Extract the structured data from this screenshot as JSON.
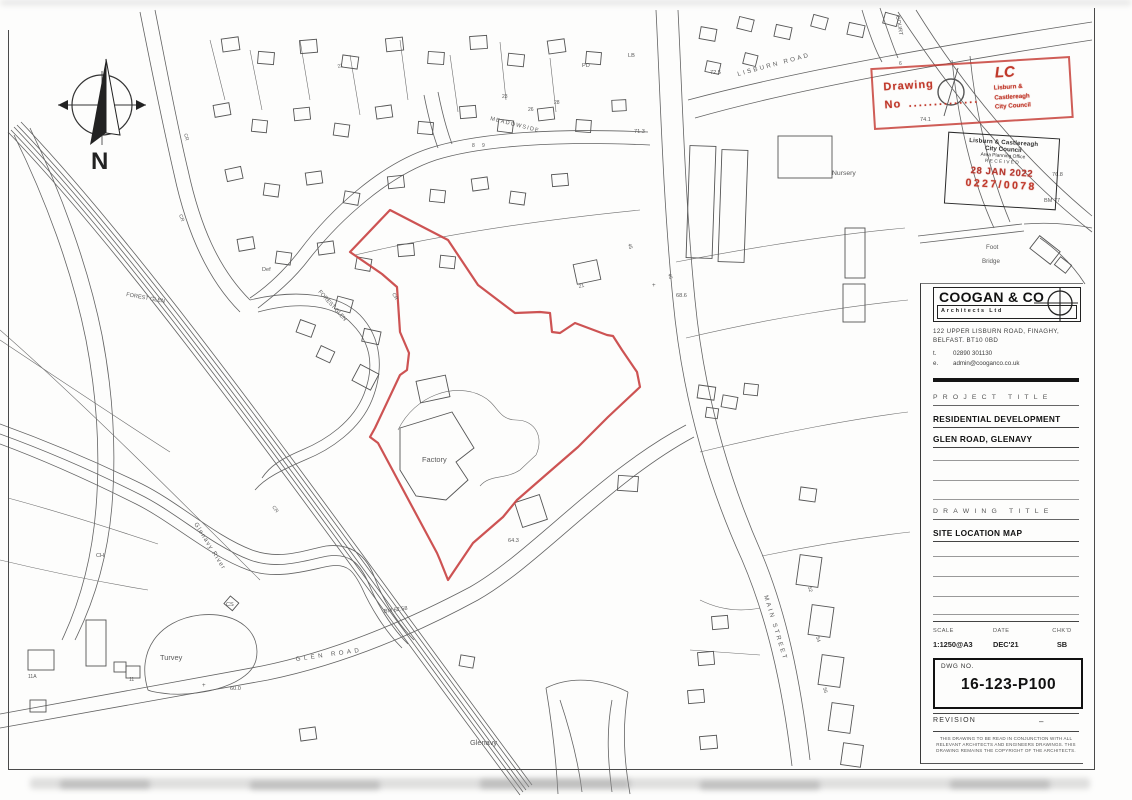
{
  "colors": {
    "boundary": "#c84040",
    "stamp_red": "#c0392b",
    "ink": "#5a5a5a"
  },
  "compass": {
    "north": "N"
  },
  "labels": {
    "meadowside": "MEADOWSIDE",
    "lisburn_road": "LISBURN ROAD",
    "court": "COURT",
    "main_street": "MAIN STREET",
    "glen_road": "GLEN ROAD",
    "forest_glen": "FOREST GLEN",
    "glenavy_river": "Glenavy River",
    "glenavy_village": "Glenavy",
    "turvey": "Turvey",
    "factory": "Factory",
    "nursery": "Nursery",
    "foot": "Foot",
    "bridge": "Bridge",
    "pd": "PD",
    "lb": "LB",
    "def": "Def",
    "cr": "CR",
    "ch": "CH",
    "cs": "CS",
    "bm77": "BM 77",
    "bm6258": "BM 62.58",
    "n72_5": "72.5",
    "n71_3": "71.3",
    "n76_8": "76.8",
    "n68_6": "68.6",
    "n64_3": "64.3",
    "n74_1": "74.1",
    "n60_0": "60.0",
    "n6": "6",
    "n8": "8",
    "n9": "9",
    "n11": "11",
    "n11a": "11A",
    "n21": "21",
    "n23": "23",
    "n26": "26",
    "n28": "28",
    "n45": "45",
    "n46": "46",
    "n52": "52",
    "n54": "54",
    "n56": "56",
    "plus": "+"
  },
  "stamps": {
    "drawing_no": {
      "label_line1": "Drawing",
      "label_line2": "No",
      "dots": "..............",
      "logo": "LC",
      "council_line1": "Lisburn &",
      "council_line2": "Castlereagh",
      "council_line3": "City Council"
    },
    "received": {
      "council_line1": "Lisburn & Castlereagh",
      "council_line2": "City Council",
      "office": "Area Planning Office",
      "received": "RECEIVED",
      "date": "28 JAN 2022",
      "ref": "0227/0078"
    }
  },
  "title_block": {
    "firm": {
      "name": "COOGAN & CO",
      "subtitle": "Architects Ltd",
      "address_line1": "122 UPPER LISBURN ROAD, FINAGHY,",
      "address_line2": "BELFAST. BT10 0BD",
      "tel_label": "t.",
      "tel": "02890   301130",
      "email_label": "e.",
      "email": "admin@cooganco.co.uk"
    },
    "project_title_header": "PROJECT TITLE",
    "project_line1": "RESIDENTIAL DEVELOPMENT",
    "project_line2": "GLEN ROAD, GLENAVY",
    "drawing_title_header": "DRAWING TITLE",
    "drawing_title": "SITE LOCATION MAP",
    "scale_label": "SCALE",
    "date_label": "DATE",
    "chkd_label": "CHK'D",
    "scale": "1:1250@A3",
    "date": "DEC'21",
    "chkd": "SB",
    "dwg_no_label": "DWG NO.",
    "dwg_no": "16-123-P100",
    "revision_label": "REVISION",
    "revision_value": "–",
    "disclaimer": "THIS DRAWING TO BE READ IN CONJUNCTION WITH ALL RELEVANT ARCHITECTS AND ENGINEERS DRAWINGS. THIS DRAWING REMAINS THE COPYRIGHT OF THE ARCHITECTS."
  }
}
